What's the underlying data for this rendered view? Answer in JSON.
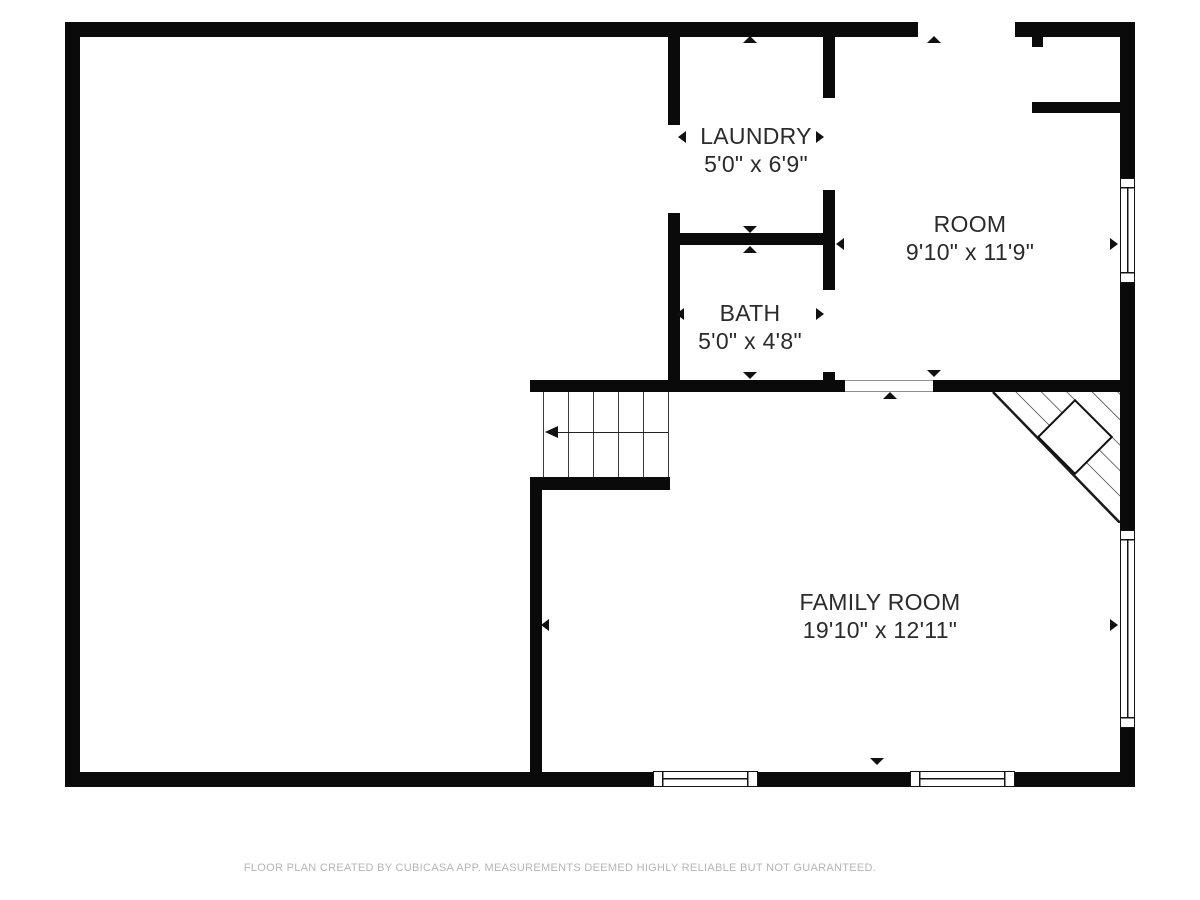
{
  "floor_plan": {
    "rooms": [
      {
        "name": "LAUNDRY",
        "dimensions": "5'0\" x 6'9\""
      },
      {
        "name": "BATH",
        "dimensions": "5'0\" x 4'8\""
      },
      {
        "name": "ROOM",
        "dimensions": "9'10\" x 11'9\""
      },
      {
        "name": "FAMILY ROOM",
        "dimensions": "19'10\" x 12'11\""
      }
    ],
    "colors": {
      "wall": "#0a0a0a",
      "label_text": "#2b2b2b",
      "footer_text": "#b5b5b5",
      "background": "#ffffff"
    }
  },
  "footer": {
    "disclaimer": "FLOOR PLAN CREATED BY CUBICASA APP. MEASUREMENTS DEEMED HIGHLY RELIABLE BUT NOT GUARANTEED."
  }
}
